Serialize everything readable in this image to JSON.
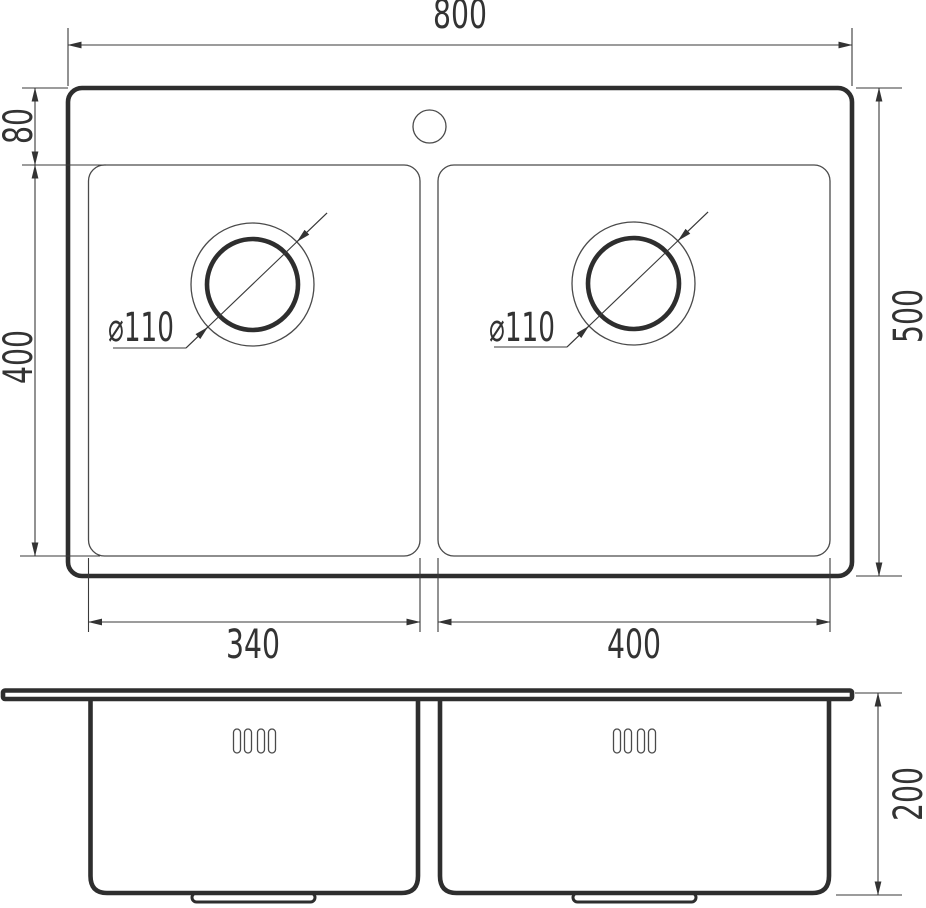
{
  "drawing": {
    "background": "#ffffff",
    "thick_line_color": "#2e2e2e",
    "thin_line_color": "#4a4a4a",
    "text_color": "#333333",
    "labels": {
      "overall_width": "800",
      "overall_depth": "500",
      "rim_top_offset": "80",
      "bowl_depth": "400",
      "left_bowl_width": "340",
      "right_bowl_width": "400",
      "left_drain_diameter": "⌀110",
      "right_drain_diameter": "⌀110",
      "side_height": "200"
    }
  }
}
